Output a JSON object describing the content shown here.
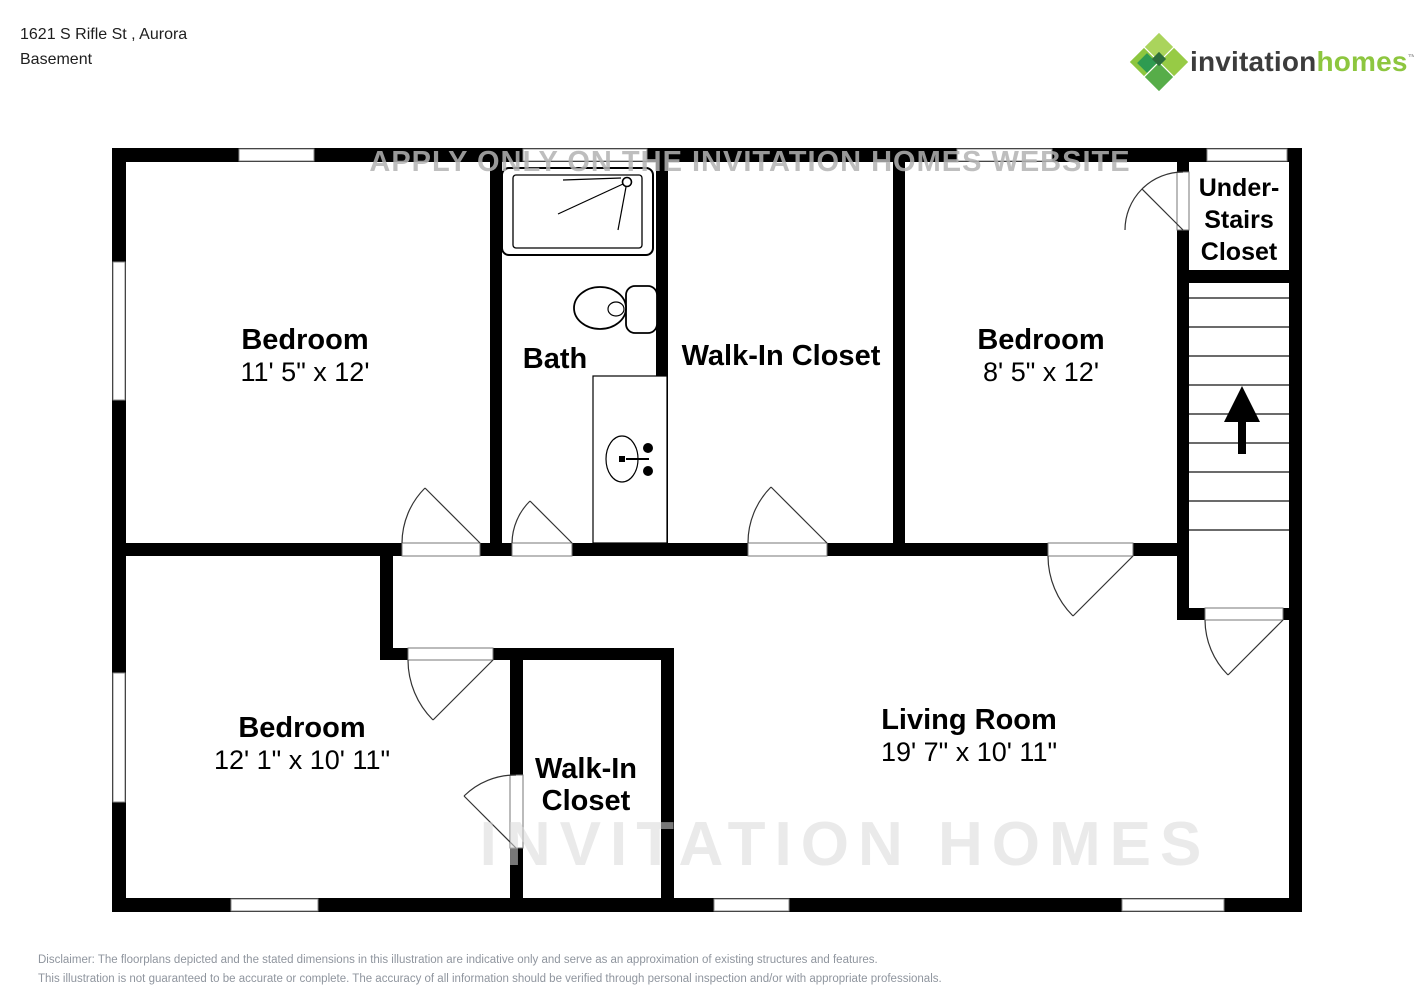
{
  "header": {
    "address": "1621 S Rifle St , Aurora",
    "floor": "Basement"
  },
  "logo": {
    "brand_first": "invitation",
    "brand_second": "homes",
    "trademark": "™"
  },
  "rooms": {
    "bedroom1": {
      "name": "Bedroom",
      "dims": "11' 5\" x 12'"
    },
    "bath": {
      "name": "Bath"
    },
    "walkin_top": {
      "name": "Walk-In Closet"
    },
    "bedroom2": {
      "name": "Bedroom",
      "dims": "8' 5\" x 12'"
    },
    "understairs": {
      "line1": "Under-",
      "line2": "Stairs",
      "line3": "Closet"
    },
    "bedroom3": {
      "name": "Bedroom",
      "dims": "12' 1\" x 10' 11\""
    },
    "walkin_bottom": {
      "line1": "Walk-In",
      "line2": "Closet"
    },
    "living": {
      "name": "Living Room",
      "dims": "19' 7\" x 10' 11\""
    }
  },
  "watermark": {
    "top": "APPLY ONLY ON THE INVITATION HOMES WEBSITE",
    "bottom": "INVITATION HOMES"
  },
  "disclaimer": {
    "line1": "Disclaimer: The floorplans depicted and the stated dimensions in this illustration are indicative only and serve as an approximation of existing structures and features.",
    "line2": "This illustration is not guaranteed to be accurate or complete. The accuracy of all information should be verified through personal inspection and/or with appropriate professionals."
  },
  "colors": {
    "wall": "#000000",
    "brand_green": "#8dc63f",
    "logo_diamond_light": "#aad45c",
    "logo_diamond_mid": "#8cc63f",
    "logo_diamond_dark": "#2e9b51",
    "disclaimer_gray": "#8f959e"
  }
}
